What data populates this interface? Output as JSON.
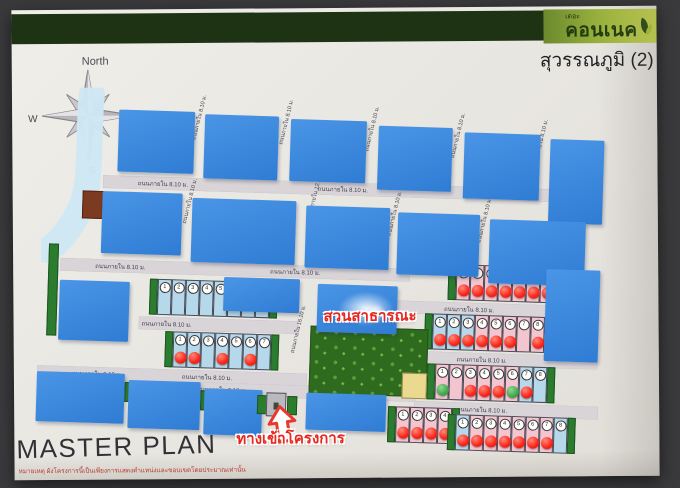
{
  "header": {
    "logo_prefix": "เดอะ",
    "logo_name": "คอนเนค",
    "project_name": "สุวรรณภูมิ (2)",
    "band_color": "#1e3214",
    "logo_gradient": [
      "#6b8a2e",
      "#c9d84d"
    ],
    "logo_text_color": "#223c0e"
  },
  "compass": {
    "north": "North",
    "west": "W",
    "east": "E",
    "south": "S"
  },
  "titles": {
    "master_plan": "MASTER PLAN",
    "disclaimer": "หมายเหตุ ผังโครงการนี้เป็นเพียงการแสดงตำแหน่งและขอบเขตโดยประมาณเท่านั้น"
  },
  "callouts": {
    "park": "สวนสาธารณะ",
    "entrance": "ทางเข้าโครงการ",
    "callout_color": "#e8281e"
  },
  "roads": {
    "label_8": "ถนนภายใน 8.10 ม.",
    "label_12": "ถนนภายใน 12.10 ม.",
    "label_16": "ถนนภายใน 16.10 ม."
  },
  "legend_colors": {
    "block_blue": "#3e87dd",
    "lot_light_blue": "#b5d9ea",
    "lot_pink": "#f3c6cf",
    "sold_dot_red": "#fb2418",
    "dot_green": "#43a94d",
    "park_green": "#2e6b1e",
    "sala_yellow": "#ead98e",
    "road_gray": "#d8d4d8",
    "hedge_green": "#2c7c2f",
    "utility_brown": "#7c3a20",
    "water_blue": "#cfe8f3"
  },
  "plan": {
    "blocks": [
      {
        "x": 74,
        "y": 14,
        "w": 76,
        "h": 62
      },
      {
        "x": 160,
        "y": 16,
        "w": 74,
        "h": 64
      },
      {
        "x": 246,
        "y": 18,
        "w": 76,
        "h": 62
      },
      {
        "x": 334,
        "y": 22,
        "w": 74,
        "h": 64
      },
      {
        "x": 420,
        "y": 26,
        "w": 76,
        "h": 66
      },
      {
        "x": 506,
        "y": 30,
        "w": 54,
        "h": 84
      },
      {
        "x": 60,
        "y": 96,
        "w": 80,
        "h": 62
      },
      {
        "x": 150,
        "y": 100,
        "w": 104,
        "h": 64
      },
      {
        "x": 264,
        "y": 104,
        "w": 84,
        "h": 62
      },
      {
        "x": 356,
        "y": 108,
        "w": 82,
        "h": 62
      },
      {
        "x": 448,
        "y": 112,
        "w": 96,
        "h": 64
      },
      {
        "x": 20,
        "y": 186,
        "w": 70,
        "h": 60
      },
      {
        "x": 184,
        "y": 178,
        "w": 76,
        "h": 34
      },
      {
        "x": 278,
        "y": 182,
        "w": 80,
        "h": 48
      },
      {
        "x": 506,
        "y": 160,
        "w": 54,
        "h": 92
      },
      {
        "x": 0,
        "y": 278,
        "w": 88,
        "h": 50
      },
      {
        "x": 92,
        "y": 284,
        "w": 72,
        "h": 48
      },
      {
        "x": 168,
        "y": 290,
        "w": 58,
        "h": 46
      },
      {
        "x": 270,
        "y": 291,
        "w": 80,
        "h": 37
      }
    ],
    "brown_lot": {
      "x": 40,
      "y": 96,
      "w": 19,
      "h": 26
    },
    "roads_h": [
      {
        "x": 60,
        "y": 80,
        "w": 460,
        "labels": [
          120,
          300,
          462
        ]
      },
      {
        "x": 20,
        "y": 164,
        "w": 350,
        "labels": [
          80,
          255
        ]
      },
      {
        "x": 100,
        "y": 220,
        "w": 160,
        "labels": [
          128
        ]
      },
      {
        "x": 358,
        "y": 196,
        "w": 202,
        "labels": [
          430
        ]
      },
      {
        "x": 0,
        "y": 272,
        "w": 270,
        "labels": [
          60,
          170
        ]
      },
      {
        "x": 380,
        "y": 246,
        "w": 180,
        "labels": [
          444
        ]
      },
      {
        "x": 128,
        "y": 284,
        "w": 252,
        "labels": [
          185,
          306
        ]
      },
      {
        "x": 378,
        "y": 296,
        "w": 184,
        "labels": [
          446
        ]
      }
    ],
    "road_v_labels": [
      {
        "x": 150,
        "y": 38,
        "size": "8"
      },
      {
        "x": 237,
        "y": 40,
        "size": "8"
      },
      {
        "x": 323,
        "y": 44,
        "size": "8"
      },
      {
        "x": 409,
        "y": 48,
        "size": "8"
      },
      {
        "x": 492,
        "y": 52,
        "size": "8"
      },
      {
        "x": 143,
        "y": 122,
        "size": "8"
      },
      {
        "x": 348,
        "y": 128,
        "size": "8"
      },
      {
        "x": 438,
        "y": 132,
        "size": "8"
      },
      {
        "x": 268,
        "y": 112,
        "size": "12"
      },
      {
        "x": 255,
        "y": 248,
        "size": "16"
      }
    ],
    "lot_rows": [
      {
        "x": 110,
        "y": 182,
        "n": 8,
        "color": "lb",
        "red": [],
        "green": []
      },
      {
        "x": 127,
        "y": 234,
        "n": 7,
        "color": "lb",
        "red": [
          0,
          1,
          3,
          5
        ],
        "green": []
      },
      {
        "x": 408,
        "y": 158,
        "n": 7,
        "color": "pk",
        "red": [
          0,
          1,
          2,
          3,
          4,
          5,
          6
        ],
        "green": []
      },
      {
        "x": 386,
        "y": 208,
        "n": 10,
        "color": "pk",
        "blues": [
          0,
          1,
          2
        ],
        "red": [
          0,
          1,
          2,
          3,
          4,
          5,
          7,
          9
        ],
        "green": []
      },
      {
        "x": 390,
        "y": 258,
        "n": 8,
        "color": "pk",
        "blues": [
          6,
          7
        ],
        "red": [
          2,
          3,
          4,
          6
        ],
        "green": [
          0,
          5
        ]
      },
      {
        "x": 352,
        "y": 302,
        "n": 4,
        "color": "pk",
        "red": [
          0,
          1,
          2,
          3
        ],
        "green": []
      },
      {
        "x": 412,
        "y": 308,
        "n": 8,
        "color": "pk",
        "blues": [
          0,
          7
        ],
        "red": [
          0,
          1,
          2,
          3,
          4,
          5,
          6
        ],
        "green": []
      }
    ],
    "hedges": [
      {
        "x": 8,
        "y": 150,
        "w": 8,
        "h": 90
      },
      {
        "x": 88,
        "y": 286,
        "w": 6,
        "h": 18
      },
      {
        "x": 164,
        "y": 292,
        "w": 6,
        "h": 18
      }
    ],
    "park": {
      "x": 272,
      "y": 224,
      "w": 116,
      "h": 66
    },
    "sala": {
      "x": 365,
      "y": 268,
      "w": 23,
      "h": 24
    },
    "entrance": {
      "x": 230,
      "y": 292,
      "w": 20,
      "h": 24
    }
  }
}
